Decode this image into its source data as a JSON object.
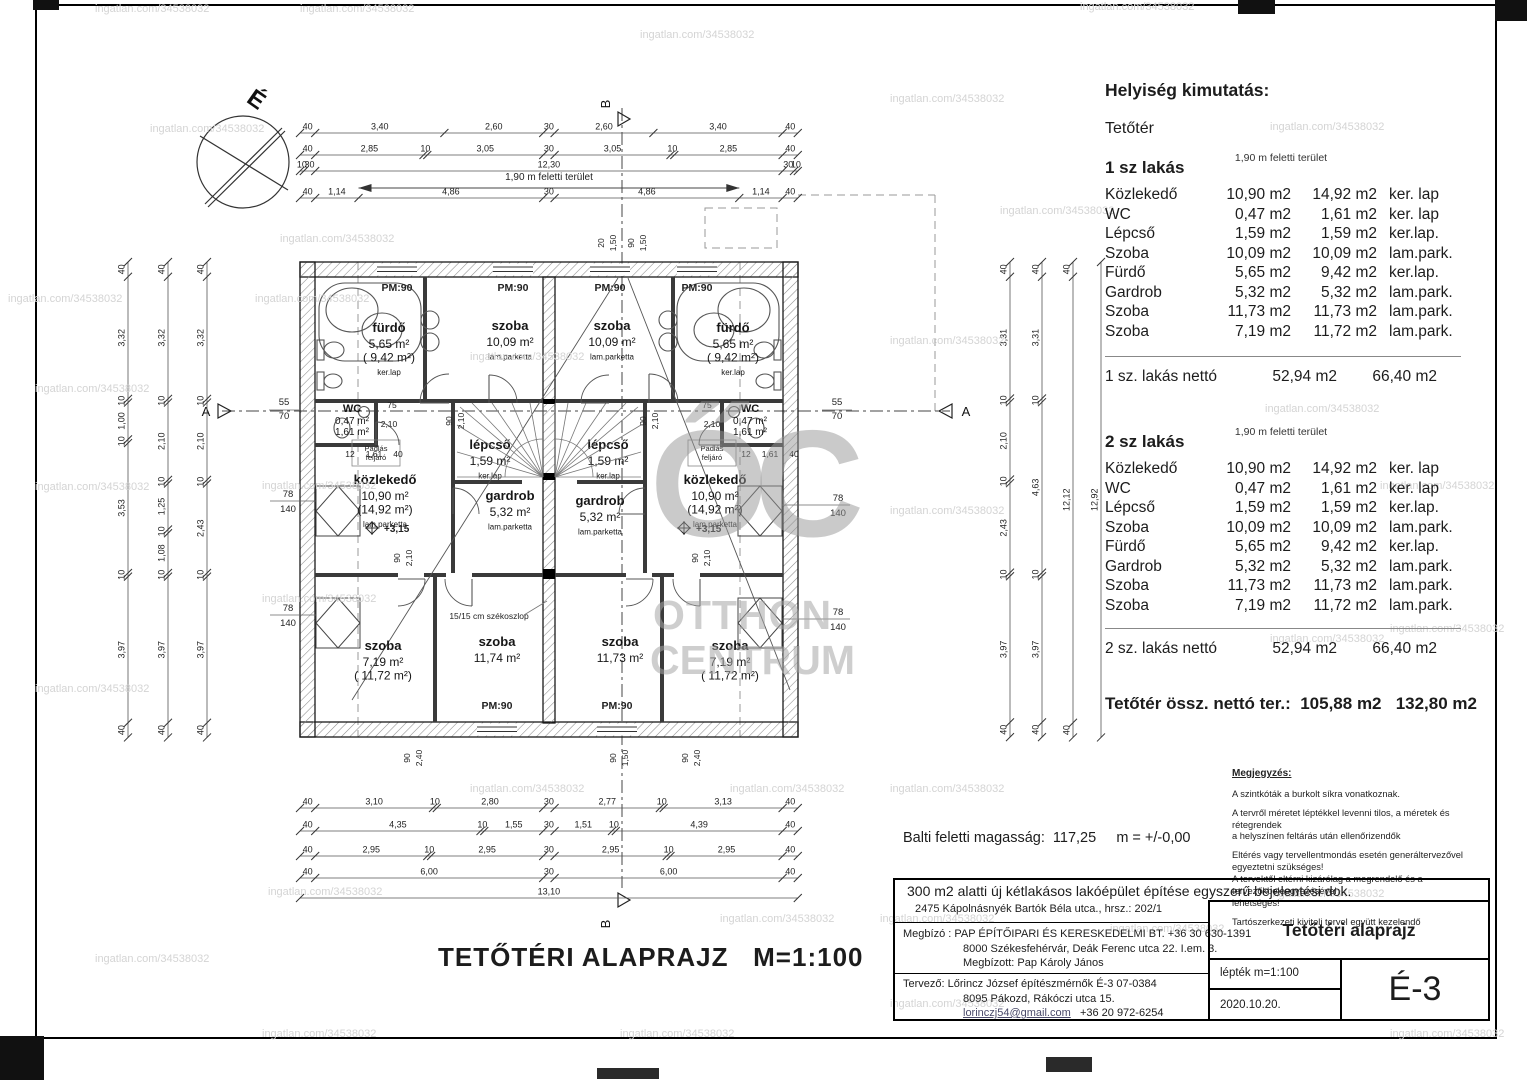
{
  "watermark": {
    "text": "ingatlan.com/34538032",
    "big1": "ŐC",
    "big2": "OTTHON",
    "big3": "CENTRUM"
  },
  "main_title": "TETŐTÉRI ALAPRAJZ   M=1:100",
  "baltic": "Balti feletti magasság:  117,25     m = +/-0,00",
  "schedule": {
    "title": "Helyiség kimutatás:",
    "level": "Tetőtér",
    "col_note": "1,90 m feletti terület",
    "units": [
      {
        "name": "1 sz lakás",
        "rows": [
          [
            "Közlekedő",
            "10,90 m2",
            "14,92 m2",
            "ker. lap"
          ],
          [
            "WC",
            "0,47 m2",
            "1,61 m2",
            "ker. lap"
          ],
          [
            "Lépcső",
            "1,59 m2",
            "1,59 m2",
            "ker.lap."
          ],
          [
            "Szoba",
            "10,09 m2",
            "10,09 m2",
            "lam.park."
          ],
          [
            "Fürdő",
            "5,65 m2",
            "9,42 m2",
            "ker.lap."
          ],
          [
            "Gardrob",
            "5,32 m2",
            "5,32 m2",
            "lam.park."
          ],
          [
            "Szoba",
            "11,73 m2",
            "11,73 m2",
            "lam.park."
          ],
          [
            "Szoba",
            "7,19 m2",
            "11,72 m2",
            "lam.park."
          ]
        ],
        "net_label": "1 sz. lakás nettó",
        "net1": "52,94 m2",
        "net2": "66,40 m2"
      },
      {
        "name": "2 sz lakás",
        "rows": [
          [
            "Közlekedő",
            "10,90 m2",
            "14,92 m2",
            "ker. lap"
          ],
          [
            "WC",
            "0,47 m2",
            "1,61 m2",
            "ker. lap"
          ],
          [
            "Lépcső",
            "1,59 m2",
            "1,59 m2",
            "ker.lap."
          ],
          [
            "Szoba",
            "10,09 m2",
            "10,09 m2",
            "lam.park."
          ],
          [
            "Fürdő",
            "5,65 m2",
            "9,42 m2",
            "ker.lap."
          ],
          [
            "Gardrob",
            "5,32 m2",
            "5,32 m2",
            "lam.park."
          ],
          [
            "Szoba",
            "11,73 m2",
            "11,73 m2",
            "lam.park."
          ],
          [
            "Szoba",
            "7,19 m2",
            "11,72 m2",
            "lam.park."
          ]
        ],
        "net_label": "2 sz. lakás nettó",
        "net1": "52,94 m2",
        "net2": "66,40 m2"
      }
    ],
    "total_label": "Tetőtér össz. nettó ter.:",
    "total1": "105,88 m2",
    "total2": "132,80 m2"
  },
  "notes": {
    "title": "Megjegyzés:",
    "items": [
      "A szintkóták a burkolt síkra vonatkoznak.",
      "A tervről méretet léptékkel levenni tilos, a méretek és rétegrendek\n a helyszínen feltárás után ellenőrizendők",
      "Eltérés vagy tervellentmondás esetén generáltervezővel egyeztetni szükséges!\nA tervektől eltérni kizárólag a megrendelő és a tervezőkbeleegyezésével\nlehetséges!",
      "Tartószerkezeti kiviteli tervel együtt kezelendő"
    ]
  },
  "titleblock": {
    "row1": "300 m2 alatti új kétlakásos lakóépület  építése egyszerű bejelentési  dok.",
    "row2": "2475 Kápolnásnyék Bartók Béla utca., hrsz.: 202/1",
    "client_lines": [
      "Megbízó : PAP ÉPÍTŐIPARI ÉS KERESKEDELMI BT.    +36 30 630-1391",
      "8000 Székesfehérvár, Deák Ferenc utca 22. I.em. 3.",
      "Megbízott: Pap Károly János"
    ],
    "designer_lines": [
      "Tervező: Lőrincz József  építészmérnők  É-3 07-0384",
      "8095 Pákozd, Rákóczi  utca 15."
    ],
    "designer_email": "lorinczj54@gmail.com",
    "designer_phone": "+36 20 972-6254",
    "drawing_name": "Tetőtéri alaprajz",
    "scale": "lépték m=1:100",
    "date": "2020.10.20.",
    "sheet": "É-3"
  },
  "plan": {
    "compass_label": "É",
    "section_a": "A",
    "section_b": "B",
    "above_label": "1,90 m feletti terület",
    "pm_label": "PM:90",
    "window_w": "78",
    "window_h": "140",
    "offset_top": "55",
    "offset_bottom": "70",
    "attic_label": "Padlás feljáró",
    "column_note": "15/15 cm székoszlop",
    "level_mark": "+3,15",
    "rooms": [
      [
        "fürdő",
        "5,65 m²",
        "( 9,42 m²)",
        "ker.lap"
      ],
      [
        "szoba",
        "10,09 m²",
        "lam.parketta"
      ],
      [
        "WC",
        "0,47 m²",
        "1,61 m²"
      ],
      [
        "közlekedő",
        "10,90 m²",
        "(14,92 m²)",
        "lam.parketta"
      ],
      [
        "lépcső",
        "1,59 m²",
        "ker.lap"
      ],
      [
        "gardrob",
        "5,32 m²",
        "lam.parketta"
      ],
      [
        "szoba",
        "7,19 m²",
        "( 11,72 m²)"
      ],
      [
        "szoba",
        "11,74 m²"
      ],
      [
        "szoba",
        "10,09 m²",
        "lam.parketta"
      ],
      [
        "fürdő",
        "5,65 m²",
        "( 9,42 m²)",
        "ker.lap"
      ],
      [
        "WC",
        "0,47 m²",
        "1,61 m²"
      ],
      [
        "közlekedő",
        "10,90 m²",
        "(14,92 m²)",
        "lam.parketta"
      ],
      [
        "lépcső",
        "1,59 m²",
        "ker.lap"
      ],
      [
        "gardrob",
        "5,32 m²",
        "lam.parketta"
      ],
      [
        "szoba",
        "11,73 m²"
      ],
      [
        "szoba",
        "7,19 m²",
        "( 11,72 m²)"
      ]
    ],
    "smalls": [
      "75",
      "2,10",
      "12",
      "1,61",
      "40",
      "75",
      "2,10",
      "12",
      "1,61",
      "40",
      "90",
      "2,10",
      "90",
      "2,10",
      "90",
      "2,10",
      "90",
      "2,10",
      "20",
      "1,50",
      "90",
      "1,50",
      "90",
      "2,40",
      "90",
      "2,40",
      "90",
      "1,50"
    ],
    "dims": {
      "top": [
        [
          "40",
          "3,40",
          "2,60",
          "30",
          "2,60",
          "3,40",
          "40"
        ],
        [
          "40",
          "2,85",
          "10",
          "3,05",
          "30",
          "3,05",
          "10",
          "2,85",
          "40"
        ],
        [
          "10",
          "30",
          "12,30",
          "30",
          "10"
        ],
        [
          "40",
          "1,14",
          "4,86",
          "30",
          "4,86",
          "1,14",
          "40"
        ]
      ],
      "bottom": [
        [
          "40",
          "3,10",
          "10",
          "2,80",
          "30",
          "2,77",
          "10",
          "3,13",
          "40"
        ],
        [
          "40",
          "4,35",
          "10",
          "1,55",
          "30",
          "1,51",
          "10",
          "4,39",
          "40"
        ],
        [
          "40",
          "2,95",
          "10",
          "2,95",
          "30",
          "2,95",
          "10",
          "2,95",
          "40"
        ],
        [
          "40",
          "6,00",
          "30",
          "6,00",
          "40"
        ],
        [
          "13,10"
        ]
      ],
      "left": [
        [
          "40",
          "3,32",
          "10",
          "1,00",
          "10",
          "3,53",
          "10",
          "3,97",
          "40"
        ],
        [
          "40",
          "3,32",
          "10",
          "2,10",
          "10",
          "1,25",
          "10",
          "1,08",
          "10",
          "3,97",
          "40"
        ],
        [
          "40",
          "3,32",
          "10",
          "2,10",
          "10",
          "2,43",
          "10",
          "3,97",
          "40"
        ]
      ],
      "right": [
        [
          "40",
          "3,31",
          "10",
          "2,10",
          "10",
          "2,43",
          "10",
          "3,97",
          "40"
        ],
        [
          "40",
          "3,31",
          "10",
          "4,63",
          "10",
          "3,97",
          "40"
        ],
        [
          "40",
          "12,12",
          "40"
        ],
        [
          "12,92"
        ]
      ]
    }
  }
}
